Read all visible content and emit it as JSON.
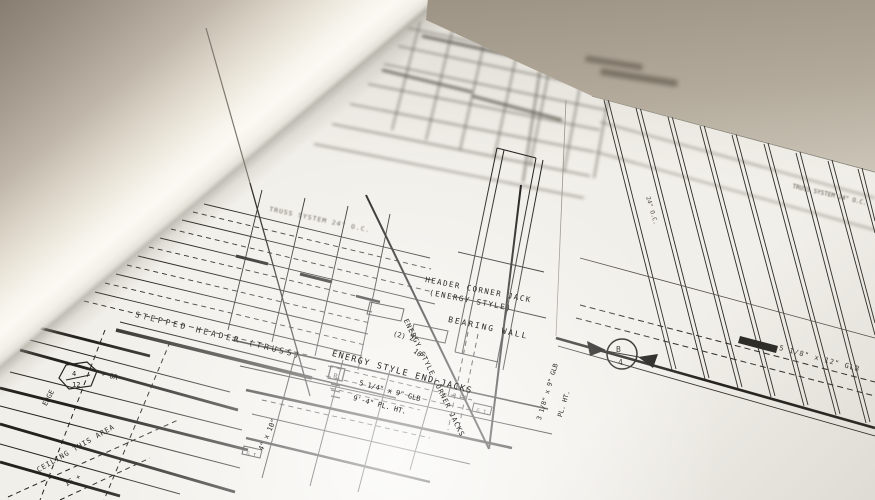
{
  "annotations": {
    "header_corner_jack_line1": "HEADER CORNER JACK",
    "header_corner_jack_line2": "(ENERGY STYLE)",
    "bearing_wall": "BEARING WALL",
    "energy_style_end_jacks": "ENERGY STYLE END JACKS",
    "energy_style_corner_jacks": "ENERGY STYLE CORNER JACKS",
    "stepped_header": "STEPPED HEADER (TRUSS)",
    "glb_beam_small": "5 1/4\" x 9\" GLB",
    "plate_height": "9'-4\" PL. HT.",
    "double_2x10_part1": "(2) 2\"",
    "double_2x10_part2": "10\"",
    "beam_4x10": "4\" x 10\"",
    "glb_beam_rotated": "3 1/8\" x 9\" GLB",
    "plate_height_rotated": "PL. HT.",
    "truss_system_left": "TRUSS SYSTEM 24\" O.C.",
    "truss_system_right": "TRUSS SYSTEM 24\" O.C.",
    "truss_spacing_rotated": "24\" O.C.",
    "glb_beam_large": "5 1/8\" x 12\" GLB",
    "ceiling_note_line1": "CEILING THIS AREA",
    "ceiling_note_line2": "IS +",
    "edge_label": "EDGE",
    "slope_suffix": "+ OR"
  },
  "symbols": {
    "roof_slope_hex": {
      "numerator": "4",
      "denominator": "12"
    },
    "section_marker": {
      "letter": "B",
      "number": "4"
    },
    "boxed_marker": "R",
    "gi_marker_1": "G.I.",
    "gi_marker_2": "G.I.",
    "gi_marker_3": "G.I."
  },
  "colors": {
    "paper": "#f1efe9",
    "ink": "#23221e",
    "roll_highlight": "#fbf9f3",
    "roll_shadow": "#877e71",
    "backdrop_tan": "#a0968a"
  }
}
